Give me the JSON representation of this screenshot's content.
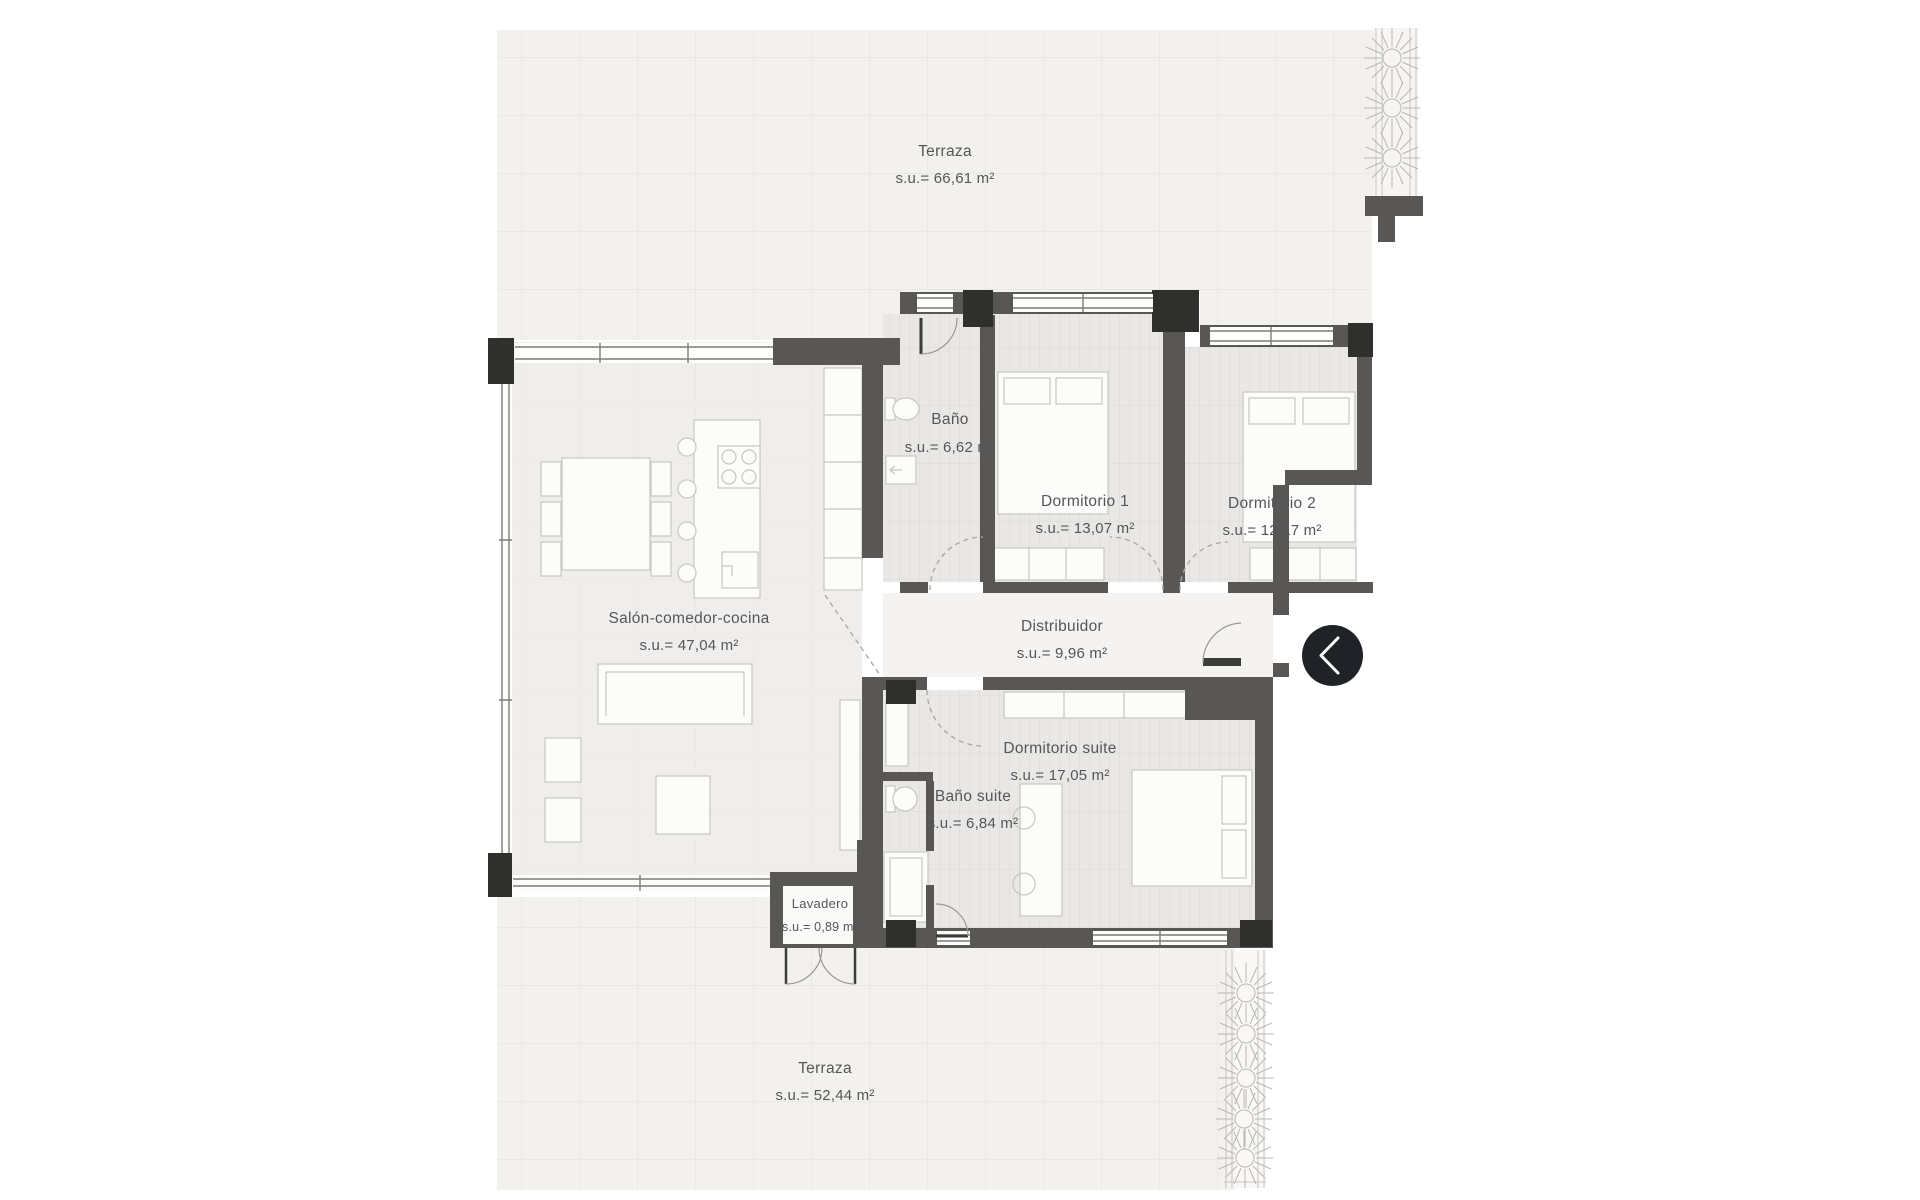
{
  "plan": {
    "title": "Apartment floor plan",
    "rooms": [
      {
        "id": "terraza-top",
        "name": "Terraza",
        "area": "s.u.= 66,61 m²"
      },
      {
        "id": "bano",
        "name": "Baño",
        "area": "s.u.= 6,62 m²"
      },
      {
        "id": "dormitorio-1",
        "name": "Dormitorio 1",
        "area": "s.u.= 13,07 m²"
      },
      {
        "id": "dormitorio-2",
        "name": "Dormitorio 2",
        "area": "s.u.= 12,17 m²"
      },
      {
        "id": "salon",
        "name": "Salón-comedor-cocina",
        "area": "s.u.= 47,04 m²"
      },
      {
        "id": "distribuidor",
        "name": "Distribuidor",
        "area": "s.u.= 9,96 m²"
      },
      {
        "id": "dormitorio-suite",
        "name": "Dormitorio suite",
        "area": "s.u.= 17,05 m²"
      },
      {
        "id": "bano-suite",
        "name": "Baño suite",
        "area": "s.u.= 6,84 m²"
      },
      {
        "id": "lavadero",
        "name": "Lavadero",
        "area": "s.u.= 0,89 m²"
      },
      {
        "id": "terraza-bottom",
        "name": "Terraza",
        "area": "s.u.= 52,44 m²"
      }
    ],
    "colors": {
      "background": "#ffffff",
      "wall": "#595755",
      "column": "#2f2f2e",
      "terrace_floor": "#f2f1ee",
      "room_floor": "#ebe9e7",
      "corridor_floor": "#f4f3f1",
      "label_text": "#565658",
      "nav_button": "#1f2227"
    }
  },
  "nav": {
    "back_button": {
      "icon": "chevron-left"
    }
  }
}
